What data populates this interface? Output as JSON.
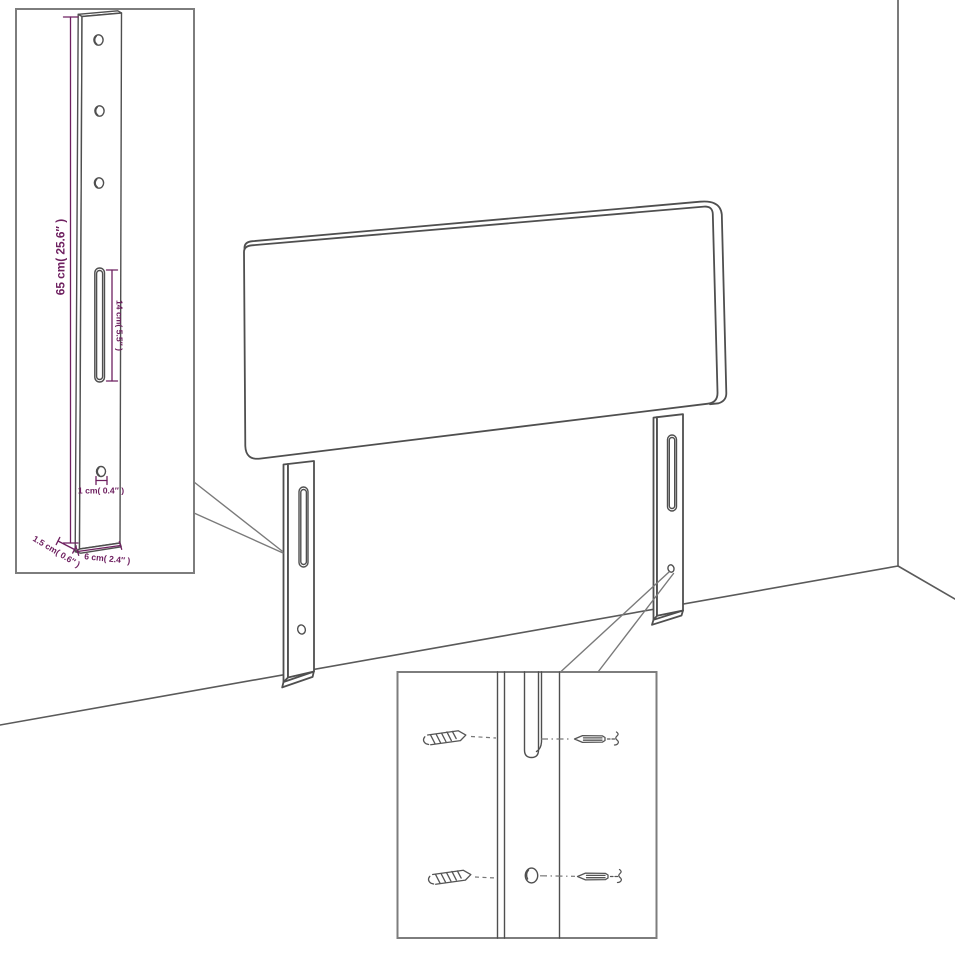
{
  "colors": {
    "background": "#ffffff",
    "drawing_line": "#4f4f4f",
    "inset_border": "#7d7d7d",
    "dimension_accent": "#6e2060"
  },
  "diagram": {
    "subject": "headboard with two slotted mounting legs shown in a room corner, with leg-detail and screw-mounting insets",
    "dimensions": {
      "leg_height": "65 cm( 25.6″ )",
      "slot_length": "14 cm( 5.5″ )",
      "hole_diameter": "1 cm( 0.4″ )",
      "leg_width": "6 cm( 2.4″ )",
      "leg_thickness": "1.5 cm( 0.6″ )"
    },
    "icons": {
      "wood_screw": "screw-side-icon",
      "machine_screw": "screw-front-icon",
      "break_mark": "squiggle-icon"
    }
  }
}
